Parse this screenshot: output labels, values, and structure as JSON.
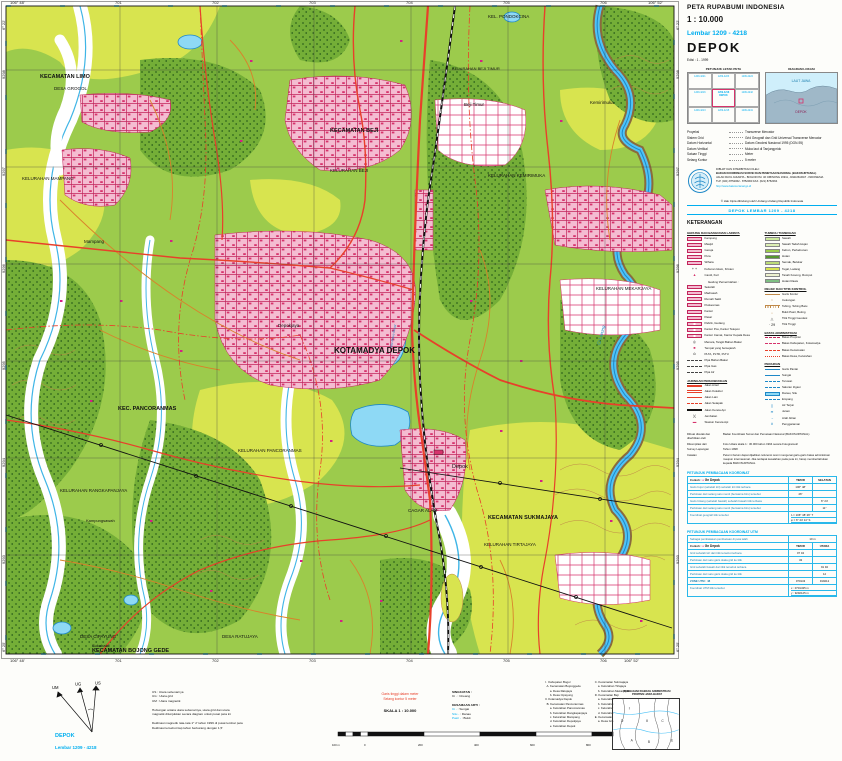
{
  "header": {
    "series": "PETA RUPABUMI  INDONESIA",
    "scale": "1 : 10.000",
    "sheet": "Lembar 1209 - 4218",
    "name": "DEPOK",
    "edition": "Edisi : 1 - 1999"
  },
  "index_maps": {
    "locator_title": "PETUNJUK LETAK PETA",
    "diagram_title": "DIAGRAM LOKASI",
    "diagram": {
      "sea_label": "LAUT JAWA",
      "marker_label": "DEPOK"
    },
    "cells": [
      {
        "no": "1209-4221",
        "name": ""
      },
      {
        "no": "1209-4223",
        "name": ""
      },
      {
        "no": "1209-4224",
        "name": ""
      },
      {
        "no": "1209-4216",
        "name": ""
      },
      {
        "no": "1209-4218",
        "name": "DEPOK"
      },
      {
        "no": "1209-4242",
        "name": ""
      },
      {
        "no": "1209-4213",
        "name": ""
      },
      {
        "no": "1209-4215",
        "name": ""
      },
      {
        "no": "1209-4241",
        "name": ""
      }
    ]
  },
  "projection": {
    "rows": [
      {
        "label": "Proyeksi",
        "value": "Transverse Mercator"
      },
      {
        "label": "Sistem Grid",
        "value": "Grid Geografi dan Grid Universal Transverse Mercator"
      },
      {
        "label": "Datum Horizontal",
        "value": "Datum Geodesi Nasional 1995 (DGN-95)"
      },
      {
        "label": "Datum Vertikal",
        "value": "Muka laut di Tanjungpriok"
      },
      {
        "label": "Satuan Tinggi",
        "value": "Meter"
      },
      {
        "label": "Selang Kontur",
        "value": "5 meter"
      }
    ]
  },
  "publisher": {
    "lines": [
      "DIBUAT DAN DITERBITKAN OLEH :",
      "BADAN KOORDINASI SURVEI DAN PEMETAAN NASIONAL (BAKOSURTANAL)",
      "JALAN RAYA JAKARTA - BOGOR KM. 46 CIBINONG 16911, JAWA BARAT - INDONESIA",
      "TLP. (021) 8752062 - 8752063   FAX. (021) 8752064"
    ],
    "url": "http://www.bakosurtanal.go.id"
  },
  "copyright": "© Hak Cipta dilindungi oleh Undang-Undang Republik Indonesia",
  "sheet_banner": "DEPOK  LEMBAR  1209 - 4218",
  "legend": {
    "title": "KETERANGAN",
    "columns": [
      {
        "sections": [
          {
            "title": "GEDUNG DAN BANGUNAN LAINNYA",
            "items": [
              {
                "k": "k-pink",
                "label": "Kampung"
              },
              {
                "k": "k-pink",
                "label": "Masjid"
              },
              {
                "k": "k-pink",
                "label": "Gereja"
              },
              {
                "k": "k-pink",
                "label": "Pura"
              },
              {
                "k": "k-pink",
                "label": "Wihara"
              },
              {
                "k": "k-glyph",
                "g": "+ +",
                "gc": "#111",
                "label": "Kuburan Islam, Kristen"
              },
              {
                "k": "k-glyph",
                "g": "▲",
                "gc": "#D6336C",
                "label": "Candi, Kuil"
              }
            ]
          },
          {
            "sub": "Gedung Pemerintahan :",
            "items": [
              {
                "k": "k-pink",
                "label": "Sekolah"
              },
              {
                "k": "k-pink",
                "label": "Madrasah"
              },
              {
                "k": "k-pink",
                "label": "Rumah Sakit"
              },
              {
                "k": "k-pink",
                "label": "Puskesmas"
              },
              {
                "k": "k-pink",
                "label": "Kantor"
              },
              {
                "k": "k-pink",
                "label": "Pasar"
              },
              {
                "k": "k-pink2",
                "label": "Pabrik, Gudang"
              },
              {
                "k": "k-pink2",
                "label": "Kantor Pos, Kantor Telepon"
              },
              {
                "k": "k-pink2",
                "label": "Kantor Camat, Kantor Kepala Desa"
              },
              {
                "k": "k-glyph",
                "g": "◎",
                "gc": "#111",
                "label": "Menara, Tangki Bahan Bakar"
              },
              {
                "k": "k-glyph",
                "g": "■",
                "gc": "#D6336C",
                "label": "Tempat yang bersejarah"
              },
              {
                "k": "k-glyph",
                "g": "⊙",
                "gc": "#111",
                "label": "PLTA, PLTD, PLTU"
              },
              {
                "k": "k-pipe",
                "label": "Pipa Bahan Bakar"
              },
              {
                "k": "k-pipe",
                "label": "Pipa Gas"
              },
              {
                "k": "k-pipe",
                "label": "Pipa Air"
              }
            ]
          },
          {
            "title": "JARINGAN PERHUBUNGAN",
            "items": [
              {
                "k": "k-road1",
                "label": "Jalan Arteri"
              },
              {
                "k": "k-road2",
                "label": "Jalan Kolektor"
              },
              {
                "k": "k-road3",
                "label": "Jalan Lain"
              },
              {
                "k": "k-road4",
                "label": "Jalan Setapak"
              },
              {
                "k": "k-rail",
                "label": "Jalan Kereta Api"
              },
              {
                "k": "k-glyph",
                "g": ")(",
                "gc": "#111",
                "label": "Jembatan"
              },
              {
                "k": "k-glyph",
                "g": "▬",
                "gc": "#D6336C",
                "label": "Stasiun Kereta Api"
              }
            ]
          }
        ]
      },
      {
        "sections": [
          {
            "title": "TUMBUH TUMBUHAN",
            "items": [
              {
                "k": "swatch",
                "color": "#CDEB9C",
                "label": "Sawah"
              },
              {
                "k": "swatch",
                "color": "#DCEFB4",
                "label": "Sawah Tadah Hujan"
              },
              {
                "k": "swatch",
                "color": "#9CCB4C",
                "label": "Kebun, Perkebunan"
              },
              {
                "k": "swatch",
                "color": "#55962F",
                "label": "Hutan"
              },
              {
                "k": "swatch",
                "color": "#BCDC78",
                "label": "Semak, Belukar"
              },
              {
                "k": "swatch",
                "color": "#D8E44F",
                "label": "Tegal, Ladang"
              },
              {
                "k": "swatch",
                "color": "#EEF2CF",
                "label": "Tanah Kosong, Rumput"
              },
              {
                "k": "swatch",
                "color": "#7FBF83",
                "label": "Hutan Rawa"
              }
            ]
          },
          {
            "title": "RELIEF DAN TITIK KONTROL",
            "items": [
              {
                "k": "k-contour",
                "label": "Garis Kontur"
              },
              {
                "k": "k-glyph",
                "g": "○",
                "gc": "#C08948",
                "label": "Cekungan"
              },
              {
                "k": "k-cliff",
                "label": "Tebing, Tebing Batu"
              },
              {
                "k": "k-glyph",
                "g": "∴",
                "gc": "#C08948",
                "label": "Bukit Pasir, Beting"
              },
              {
                "k": "k-glyph",
                "g": "△",
                "gc": "#111",
                "label": "Titik Tinggi Geodesi"
              },
              {
                "k": "k-glyph",
                "g": "· 29",
                "gc": "#111",
                "label": "Titik Tinggi"
              }
            ]
          },
          {
            "title": "BATAS ADMINISTRASI",
            "items": [
              {
                "k": "k-b1",
                "label": "Batas Propinsi"
              },
              {
                "k": "k-b2",
                "label": "Batas Kabupaten, Kotamadya"
              },
              {
                "k": "k-b3",
                "label": "Batas Kecamatan"
              },
              {
                "k": "k-b4",
                "label": "Batas Desa, Kelurahan"
              }
            ]
          },
          {
            "title": "PERAIRAN",
            "items": [
              {
                "k": "k-bline",
                "label": "Garis Pantai"
              },
              {
                "k": "k-bline",
                "label": "Sungai"
              },
              {
                "k": "k-bdash",
                "label": "Terusan"
              },
              {
                "k": "k-bdash",
                "label": "Saluran Irigasi"
              },
              {
                "k": "k-water",
                "label": "Danau, Situ"
              },
              {
                "k": "k-bdash",
                "label": "Empang"
              },
              {
                "k": "k-glyph",
                "g": "∥",
                "gc": "#1E88C7",
                "label": "Air Terjun"
              },
              {
                "k": "k-glyph",
                "g": "≋",
                "gc": "#1E88C7",
                "label": "Jeram"
              },
              {
                "k": "k-glyph",
                "g": "→",
                "gc": "#1E88C7",
                "label": "Arah Aliran"
              },
              {
                "k": "k-glyph",
                "g": "#",
                "gc": "#1E88C7",
                "label": "Penggaraman"
              }
            ]
          }
        ]
      }
    ]
  },
  "source_notes": {
    "rows": [
      {
        "label": "Dibuat dicetak dan diterbitkan oleh",
        "value": "Badan Koordinasi Survei dan Pemetaan Nasional (BAKOSURTANAL)"
      },
      {
        "label": "Dikompilasi dari",
        "value": "Foto Udara skala 1 : 30.000 tahun 1994 secara Fotogrametri"
      },
      {
        "label": "Survey Lapangan",
        "value": "Tahun 1998"
      },
      {
        "label": "Catatan",
        "value": "Peta ini belum dapat dijadikan referensi resmi mengenai garis-garis batas administrasi maupun internasional. Jika terdapat kesalahan pada peta ini, harap memberitahukan kepada BAKOSURTANAL"
      }
    ]
  },
  "coord_table": {
    "title": "PETUNJUK PEMBACAAN KOORDINAT",
    "example_label": "Contoh :",
    "example_value": "Gn Depok",
    "col_headers": [
      "TIMUR",
      "SELATAN"
    ],
    "rows": [
      {
        "label": "Garis bujur (sebelah kiri) sebelah kiri titik terbaca",
        "t": "106° 48'",
        "s": ""
      },
      {
        "label": "Perkiraan dari selang satu menit (berwarna biru) tersebut",
        "t": "26\"",
        "s": ""
      },
      {
        "label": "Garis lintang (sebelah bawah) sebelah bawah titik terbaca",
        "t": "",
        "s": "6° 24'"
      },
      {
        "label": "Perkiraan dari selang satu menit (berwarna biru) tersebut",
        "t": "",
        "s": "11\""
      }
    ],
    "footer_label": "Koordinat geografi titik tersebut",
    "footer_values": [
      "λ  =  106° 48' 26\" T",
      "φ  =  6° 24' 11\" S"
    ]
  },
  "utm_table": {
    "title": "PETUNJUK PEMBACAAN KOORDINAT UTM",
    "note_label": "Sebagai pembatasan pembacaan di peta ialah",
    "note_value": "10 m",
    "example_label": "Contoh :",
    "example_value": "Gn Depok",
    "col_headers": [
      "TIMUR",
      "UTARA"
    ],
    "rows": [
      {
        "label": "Grid sebelah kiri dari titik tersebut terbaca",
        "t": "07 04",
        "s": ""
      },
      {
        "label": "Perkiraan dari satu garis skala grid ke titik",
        "t": "43",
        "s": ""
      },
      {
        "label": "Grid sebelah bawah dari titik tersebut terbaca",
        "t": "",
        "s": "91 92"
      },
      {
        "label": "Perkiraan dari satu garis skala grid ke titik",
        "t": "",
        "s": "12"
      }
    ],
    "zone_row": {
      "label": "ZONE UTM :  48",
      "t": "070143",
      "s": "919212"
    },
    "footer_label": "Koordinat UTM titik tersebut",
    "footer_values": [
      "x  :  0701435 m",
      "y  :  9292125 m"
    ]
  },
  "map": {
    "labels": [
      {
        "t": "KECAMATAN LIMO",
        "x": 40,
        "y": 78,
        "s": 5.5,
        "b": 1
      },
      {
        "t": "DESA GROGOL",
        "x": 54,
        "y": 90,
        "s": 4.5
      },
      {
        "t": "KELURAHAN MAMPANG",
        "x": 22,
        "y": 180,
        "s": 4.5
      },
      {
        "t": "Mampang",
        "x": 84,
        "y": 243,
        "s": 4.5
      },
      {
        "t": "KECAMATAN BEJI",
        "x": 330,
        "y": 132,
        "s": 5.5,
        "b": 1
      },
      {
        "t": "KELURAHAN BEJI",
        "x": 330,
        "y": 172,
        "s": 4.5
      },
      {
        "t": "KELURAHAN BEJI TIMUR",
        "x": 452,
        "y": 70,
        "s": 4
      },
      {
        "t": "Beji Timur",
        "x": 464,
        "y": 106,
        "s": 4.5
      },
      {
        "t": "KEL. PONDOKCINA",
        "x": 488,
        "y": 18,
        "s": 4.5
      },
      {
        "t": "KELURAHAN KEMIRIMUKA",
        "x": 488,
        "y": 177,
        "s": 4.5
      },
      {
        "t": "Kemirimuka",
        "x": 590,
        "y": 104,
        "s": 4.5
      },
      {
        "t": "Depokjaya",
        "x": 278,
        "y": 327,
        "s": 4.5
      },
      {
        "t": "KOTAMADYA DEPOK",
        "x": 334,
        "y": 353,
        "s": 8,
        "b": 1
      },
      {
        "t": "KEC. PANCORANMAS",
        "x": 118,
        "y": 410,
        "s": 5.5,
        "b": 1
      },
      {
        "t": "KELURAHAN PANCORANMAS",
        "x": 238,
        "y": 452,
        "s": 4.5
      },
      {
        "t": "KELURAHAN RANGKAPANJAYA",
        "x": 60,
        "y": 492,
        "s": 4.5
      },
      {
        "t": "Kampungsawah",
        "x": 86,
        "y": 522,
        "s": 4
      },
      {
        "t": "DESA CIPAYUNG",
        "x": 80,
        "y": 638,
        "s": 4.5
      },
      {
        "t": "Sukabakti",
        "x": 92,
        "y": 647,
        "s": 4
      },
      {
        "t": "KECAMATAN BOJONG GEDE",
        "x": 92,
        "y": 652,
        "s": 5.5,
        "b": 1
      },
      {
        "t": "DESA RATUJAYA",
        "x": 222,
        "y": 638,
        "s": 4.5
      },
      {
        "t": "CAGAR ALAM",
        "x": 408,
        "y": 512,
        "s": 4.5
      },
      {
        "t": "Depok",
        "x": 452,
        "y": 468,
        "s": 5.5
      },
      {
        "t": "KECAMATAN SUKMAJAYA",
        "x": 488,
        "y": 519,
        "s": 5.5,
        "b": 1
      },
      {
        "t": "KELURAHAN TIRTAJAYA",
        "x": 484,
        "y": 546,
        "s": 4.5
      },
      {
        "t": "KELURAHAN MEKARJAYA",
        "x": 596,
        "y": 290,
        "s": 4.5
      },
      {
        "t": "Ci Liwung",
        "x": 600,
        "y": 345,
        "s": 4.5,
        "c": "#1E88C7",
        "r": -75,
        "i": 1
      },
      {
        "t": "Situ Rawa Besar",
        "x": 392,
        "y": 348,
        "s": 3.2,
        "c": "#1E88C7",
        "r": -80,
        "i": 1
      }
    ],
    "grid": {
      "eastings": {
        "xs": [
          120,
          217,
          314,
          411,
          508,
          605
        ],
        "labels": [
          "701",
          "702",
          "703",
          "704",
          "705",
          "706"
        ]
      },
      "northings": {
        "ys": [
          70,
          167,
          264,
          361,
          458,
          555
        ],
        "labels": [
          "9298",
          "9297",
          "9296",
          "9295",
          "9294",
          "9293"
        ]
      },
      "corners": {
        "tl_lon": "106° 48'",
        "tr_lon": "106° 52'",
        "bl_lon": "106° 48'",
        "br_lon": "106° 52'",
        "tl_lat": "6° 22'",
        "bl_lat": "6° 25'",
        "tr_lat": "6° 22'",
        "br_lat": "6° 25'"
      }
    }
  },
  "bottom": {
    "north": {
      "um": "UM",
      "ug": "UG",
      "us": "US",
      "lines": [
        "US  :  Utara sebenarnya",
        "UG  :  Utara grid",
        "UM  :  Utara magnetik",
        "",
        "Hubungan antara utara sebenarnya, utara grid dan utara",
        "magnetik ditunjukkan secara diagram untuk pusat peta ini",
        "",
        "Deklinasi magnetik rata-rata 1° 2' tahun 1999 di pusat lembar peta",
        "Deklinasi tersebut tiap tahun berkurang dengan 1,5'"
      ]
    },
    "singkatan": {
      "title": "SINGKATAN :",
      "rows": [
        {
          "term": "Ci .",
          "meaning": "Cireang"
        }
      ]
    },
    "kesamaan": {
      "title": "KESAMAAN ARTI :",
      "rows": [
        {
          "term": "Ci -",
          "meaning": "Sungai"
        },
        {
          "term": "Situ -",
          "meaning": "Danau"
        },
        {
          "term": "Pasir -",
          "meaning": "Bukit"
        }
      ]
    },
    "contour_note": [
      "Garis tinggi dalam meter",
      "Selang kontur 5 meter"
    ],
    "scale": {
      "label": "SKALA 1 : 10.000",
      "bar_labels": [
        "100 m",
        "0",
        "200",
        "400",
        "600",
        "800",
        "1 Km"
      ]
    },
    "admin_list": {
      "col1": [
        "I.  Kabupaten Bogor",
        "  A. Kecamatan Bojonggede",
        "      a. Desa Ratujaya",
        "      b. Desa Cipayung",
        "II. Kotamadya Depok",
        "  B. Kecamatan Pancoranmas",
        "      a. Kelurahan Pancoranmas",
        "      b. Kelurahan Rangkapanjaya",
        "      c. Kelurahan Mampang",
        "      d. Kelurahan Depokjaya",
        "      e. Kelurahan Depok"
      ],
      "col2": [
        "  C. Kecamatan Sukmajaya",
        "      a. Kelurahan Tirtajaya",
        "      b. Kelurahan Mekarjaya",
        "  D. Kecamatan Beji",
        "      a. Kelurahan Kemirimuka",
        "      b. Kelurahan Beji Timur",
        "      c. Kelurahan Beji",
        "      d. Kelurahan Tanahbaru",
        "  E. Kecamatan Limo",
        "      a. Desa Grogol"
      ]
    },
    "admin_inset_title": [
      "PEMBAGIAN DAERAH ADMINISTRASI",
      "PROPINSI JAWA BARAT"
    ],
    "sheet_id": {
      "name": "DEPOK",
      "sheet": "Lembar 1209 - 4218"
    }
  },
  "colors": {
    "cyan": "#00AEEF",
    "road_red": "#E8402A",
    "urban_outline": "#C2255C",
    "water": "#8ED9F5",
    "water_line": "#1E88C7",
    "veg_base": "#9CCB4C",
    "tegalan": "#D8E44F",
    "contour": "#C08948"
  }
}
